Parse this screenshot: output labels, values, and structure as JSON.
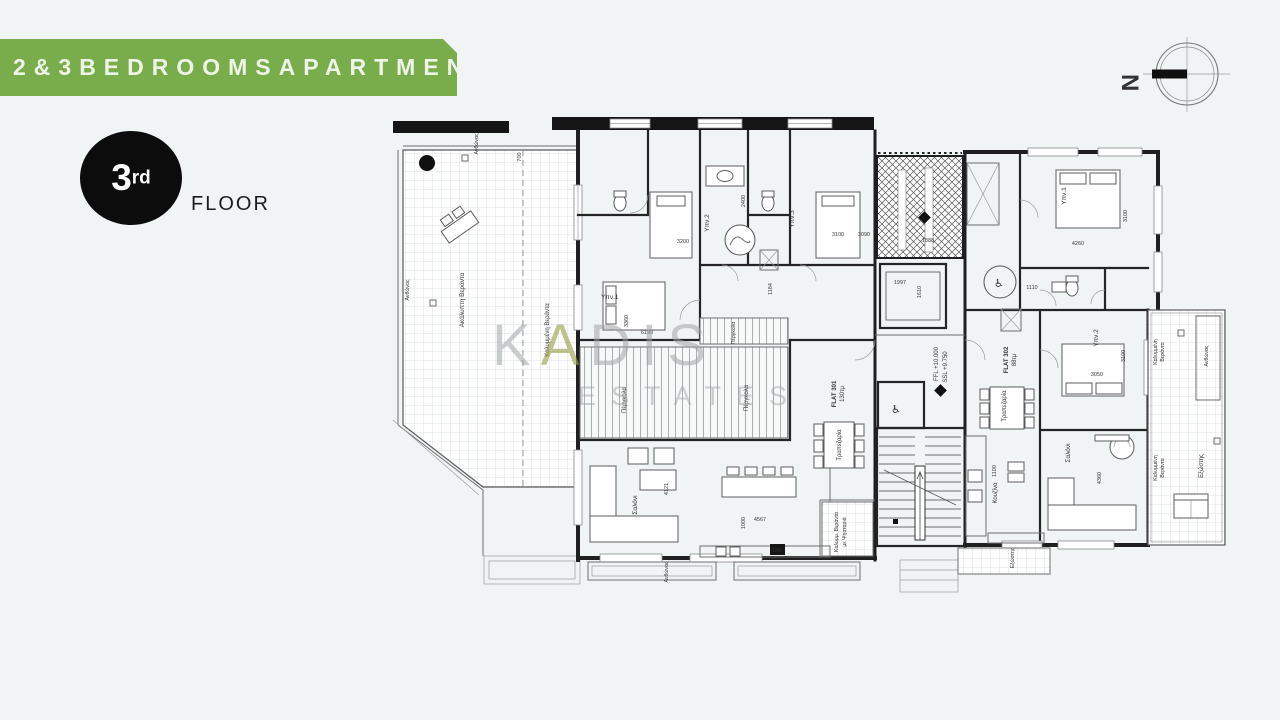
{
  "banner": {
    "text": "2&3BEDROOMSAPARTMENTS",
    "background": "#79ac4a"
  },
  "floor_badge": {
    "number": "3",
    "ordinal": "rd",
    "label": "FLOOR"
  },
  "compass": {
    "north": "N"
  },
  "watermark": {
    "k": "K",
    "a": "A",
    "dis": "DIS",
    "estates": "ESTATES"
  },
  "plan": {
    "flats": {
      "left_id": "FLAT 301",
      "left_area": "130τμ",
      "right_id": "FLAT 302",
      "right_area": "88τμ"
    },
    "levels": {
      "ffl": "FFL +10.000",
      "ssl": "SSL +9.750"
    },
    "rooms": {
      "bedroom1": "Υπν.1",
      "bedroom2": "Υπν.2",
      "bedroom3": "Υπν.3",
      "living": "Σαλόνι",
      "kitchen": "Κουζίνα",
      "dining": "Τραπεζαρία",
      "pergola": "Πέργκολα",
      "uncovered_veranda": "Ακάλυπτη Βεράντα",
      "covered_veranda": "Καλυμμένη Βεράντα",
      "covered_line1": "Καλυμμένη",
      "covered_line2": "Βεράντα",
      "bbq_line1": "Καλυμμ. Βεράντα",
      "bbq_line2": "με Ψησταριά",
      "balcony": "Εξώστης",
      "planter": "Ανθώνας",
      "dishwasher": "DW"
    },
    "dimensions": {
      "d700": "700",
      "d1000": "1000",
      "d1100": "1100",
      "d1110": "1110",
      "d1184": "1184",
      "d1610": "1610",
      "d1888": "1888",
      "d1997": "1997",
      "d2400": "2400",
      "d3050": "3050",
      "d3090": "3090",
      "d3100": "3100",
      "d3200": "3200",
      "d3360": "3360",
      "d4121": "4121",
      "d4260": "4260",
      "d4360": "4360",
      "d4567": "4567",
      "d6190": "6190"
    }
  }
}
